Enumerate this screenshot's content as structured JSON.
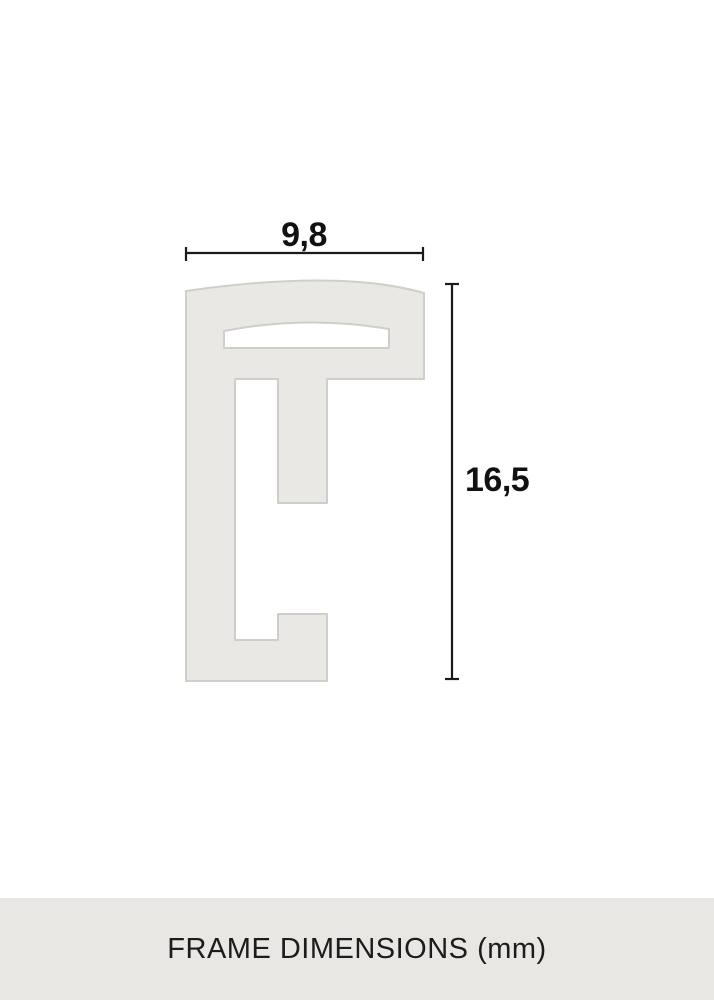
{
  "diagram": {
    "type": "technical-drawing",
    "subject": "picture frame moulding profile cross-section",
    "unit": "mm",
    "dimensions": {
      "width": {
        "value": "9,8",
        "unit": "mm"
      },
      "height": {
        "value": "16,5",
        "unit": "mm"
      }
    }
  },
  "caption": {
    "label": "FRAME DIMENSIONS (mm)"
  },
  "colors": {
    "background": "#ffffff",
    "profile_fill": "#e9e8e4",
    "profile_stroke": "#cfcec9",
    "dimension_ink": "#1a1a1a",
    "caption_bar_background": "#e8e7e3",
    "caption_text": "#1c1c1a"
  }
}
